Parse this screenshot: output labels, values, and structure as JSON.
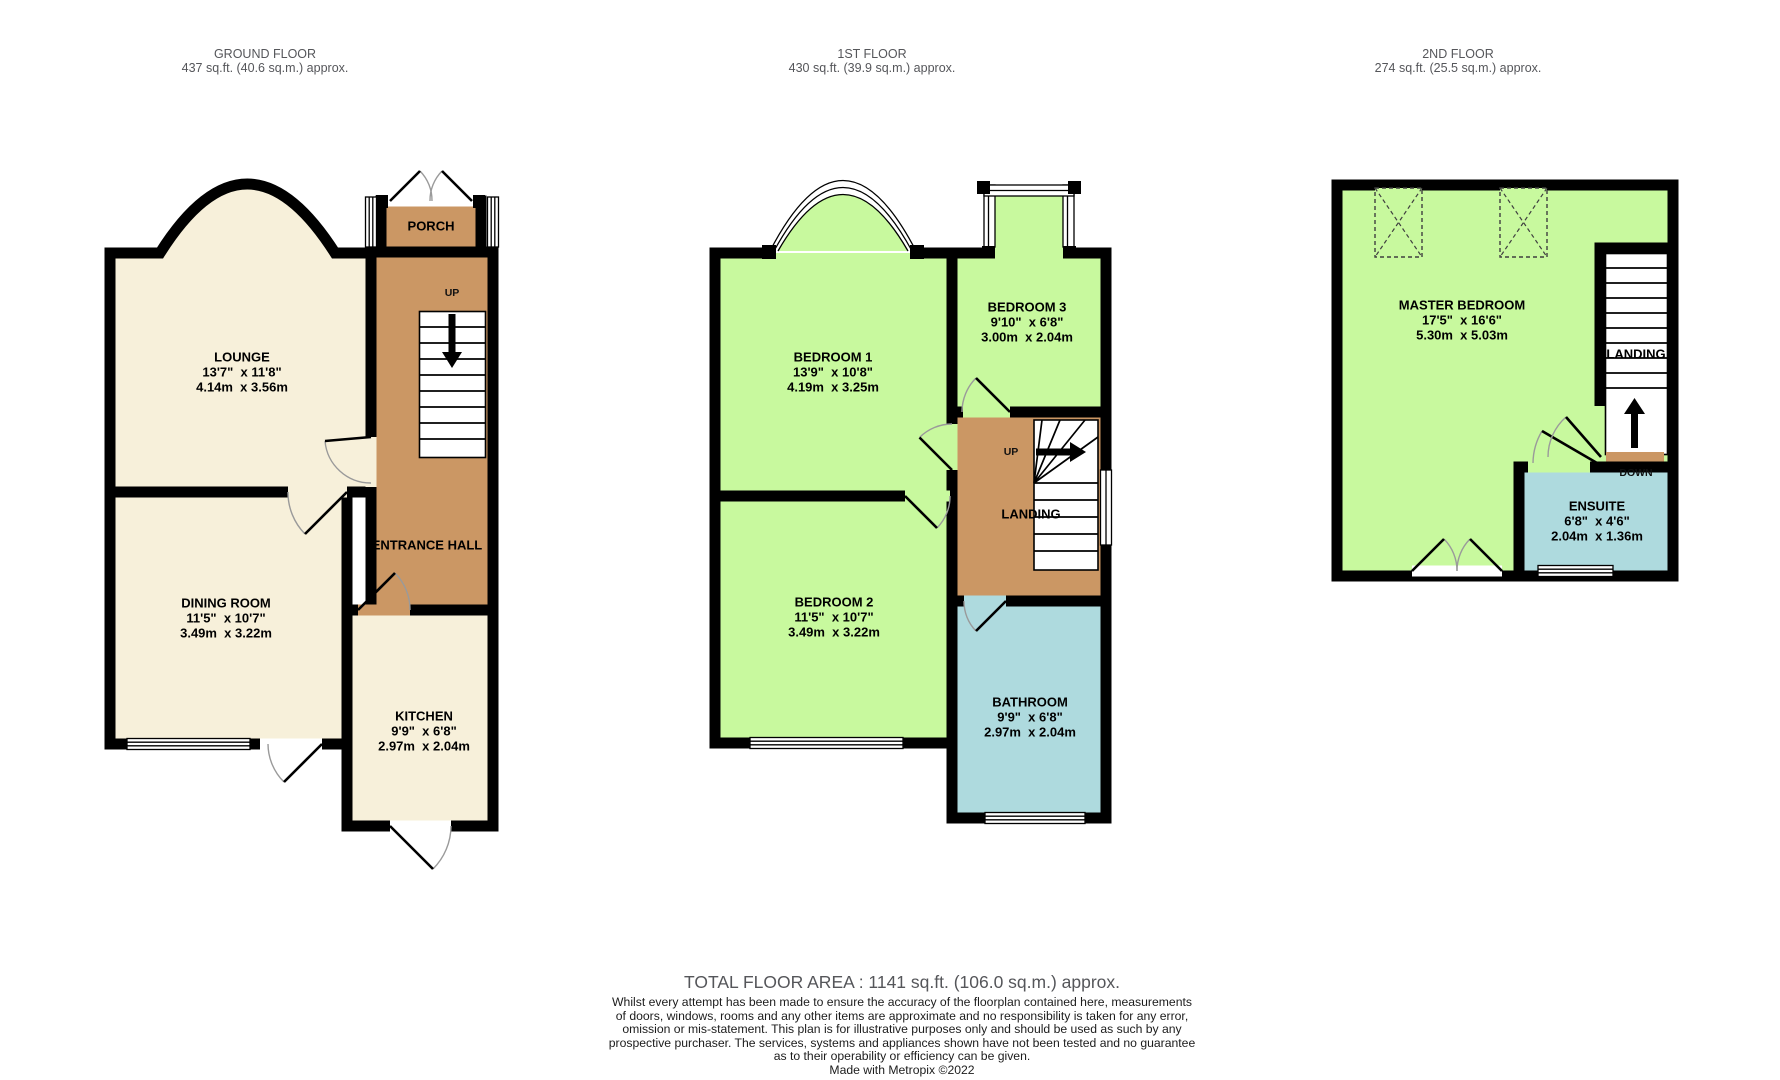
{
  "colors": {
    "wall": "#000000",
    "cream": "#f7f0da",
    "brown": "#cb9764",
    "green": "#c8f99e",
    "blue": "#aedade",
    "header_text": "#55565a",
    "label": "#000000"
  },
  "floors": [
    {
      "title": "GROUND FLOOR",
      "subtitle": "437 sq.ft. (40.6 sq.m.) approx."
    },
    {
      "title": "1ST FLOOR",
      "subtitle": "430 sq.ft. (39.9 sq.m.) approx."
    },
    {
      "title": "2ND FLOOR",
      "subtitle": "274 sq.ft. (25.5 sq.m.) approx."
    }
  ],
  "rooms": {
    "lounge": {
      "name": "LOUNGE",
      "imperial": "13'7\"  x 11'8\"",
      "metric": "4.14m  x 3.56m"
    },
    "porch": {
      "name": "PORCH"
    },
    "entrance_hall": {
      "name": "ENTRANCE HALL"
    },
    "dining_room": {
      "name": "DINING ROOM",
      "imperial": "11'5\"  x 10'7\"",
      "metric": "3.49m  x 3.22m"
    },
    "kitchen": {
      "name": "KITCHEN",
      "imperial": "9'9\"  x 6'8\"",
      "metric": "2.97m  x 2.04m"
    },
    "bedroom1": {
      "name": "BEDROOM 1",
      "imperial": "13'9\"  x 10'8\"",
      "metric": "4.19m  x 3.25m"
    },
    "bedroom2": {
      "name": "BEDROOM 2",
      "imperial": "11'5\"  x 10'7\"",
      "metric": "3.49m  x 3.22m"
    },
    "bedroom3": {
      "name": "BEDROOM 3",
      "imperial": "9'10\"  x 6'8\"",
      "metric": "3.00m  x 2.04m"
    },
    "bathroom": {
      "name": "BATHROOM",
      "imperial": "9'9\"  x 6'8\"",
      "metric": "2.97m  x 2.04m"
    },
    "landing_first": {
      "name": "LANDING"
    },
    "master_bedroom": {
      "name": "MASTER BEDROOM",
      "imperial": "17'5\"  x 16'6\"",
      "metric": "5.30m  x 5.03m"
    },
    "landing_second": {
      "name": "LANDING"
    },
    "ensuite": {
      "name": "ENSUITE",
      "imperial": "6'8\"  x 4'6\"",
      "metric": "2.04m  x 1.36m"
    }
  },
  "stair_labels": {
    "up_ground": "UP",
    "up_first": "UP",
    "down_second": "DOWN"
  },
  "footer": {
    "total": "TOTAL FLOOR AREA : 1141 sq.ft. (106.0 sq.m.) approx.",
    "disclaimer_lines": [
      "Whilst every attempt has been made to ensure the accuracy of the floorplan contained here, measurements",
      "of doors, windows, rooms and any other items are approximate and no responsibility is taken for any error,",
      "omission or mis-statement. This plan is for illustrative purposes only and should be used as such by any",
      "prospective purchaser. The services, systems and appliances shown have not been tested and no guarantee",
      "as to their operability or efficiency can be given."
    ],
    "credit": "Made with Metropix ©2022"
  }
}
